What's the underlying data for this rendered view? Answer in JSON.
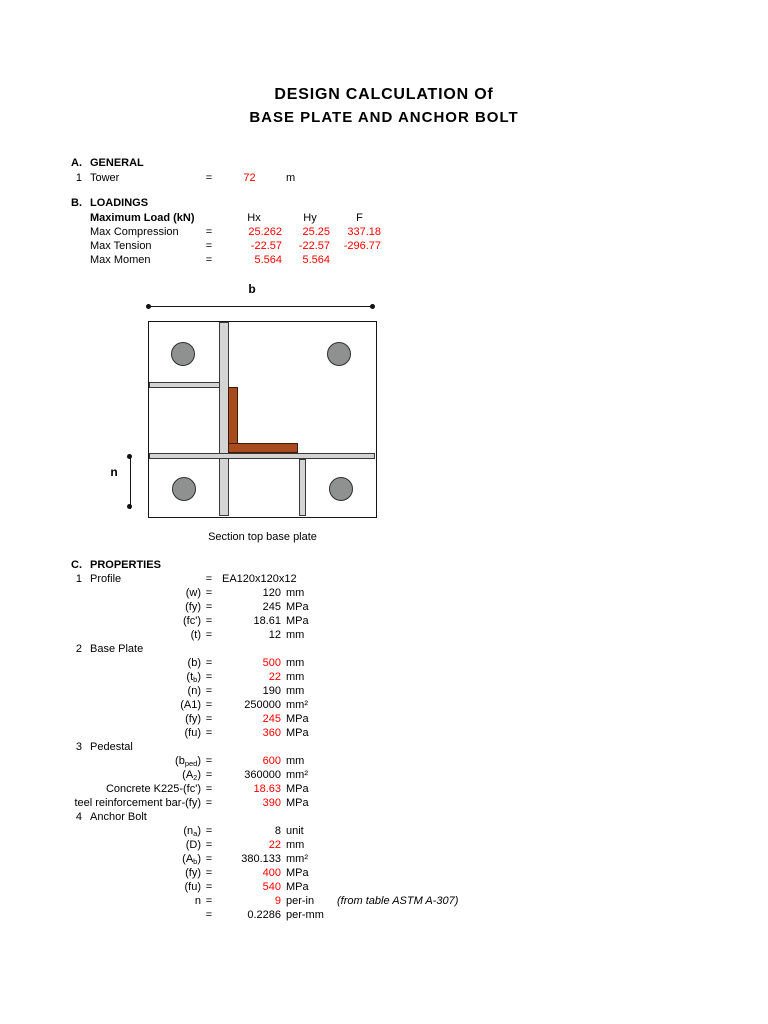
{
  "document": {
    "title_line1": "DESIGN CALCULATION Of",
    "title_line2": "BASE PLATE AND ANCHOR BOLT"
  },
  "colors": {
    "value_red": "#ff0000",
    "text": "#000000",
    "stiffener_fill": "#d4d4d4",
    "bolt_fill": "#8f9191",
    "angle_fill": "#a84b1e"
  },
  "general": {
    "letter": "A.",
    "heading": "GENERAL",
    "rows": [
      {
        "num": "1",
        "label": "Tower",
        "eq": "=",
        "value": "72",
        "red": true,
        "unit": "m"
      }
    ]
  },
  "loadings": {
    "letter": "B.",
    "heading": "LOADINGS",
    "header_label": "Maximum Load (kN)",
    "col_headers": [
      "Hx",
      "Hy",
      "F"
    ],
    "rows": [
      {
        "label": "Max Compression",
        "eq": "=",
        "values": [
          "25.262",
          "25.25",
          "337.18"
        ]
      },
      {
        "label": "Max Tension",
        "eq": "=",
        "values": [
          "-22.57",
          "-22.57",
          "-296.77"
        ]
      },
      {
        "label": "Max Momen",
        "eq": "=",
        "values": [
          "5.564",
          "5.564",
          ""
        ]
      }
    ]
  },
  "diagram": {
    "dim_width_label": "b",
    "dim_height_label": "n",
    "caption": "Section top base plate"
  },
  "properties": {
    "letter": "C.",
    "heading": "PROPERTIES",
    "rows": [
      {
        "type": "item",
        "num": "1",
        "label": "Profile",
        "eq": "=",
        "text_value": "EA120x120x12"
      },
      {
        "type": "param",
        "pre": "(w)",
        "eq": "=",
        "value": "120",
        "red": false,
        "unit": "mm"
      },
      {
        "type": "param",
        "pre": "(fy)",
        "eq": "=",
        "value": "245",
        "red": false,
        "unit": "MPa"
      },
      {
        "type": "param",
        "pre": "(fc')",
        "eq": "=",
        "value": "18.61",
        "red": false,
        "unit": "MPa"
      },
      {
        "type": "param",
        "pre": "(t)",
        "eq": "=",
        "value": "12",
        "red": false,
        "unit": "mm"
      },
      {
        "type": "item",
        "num": "2",
        "label": "Base Plate"
      },
      {
        "type": "param",
        "pre": "(b)",
        "eq": "=",
        "value": "500",
        "red": true,
        "unit": "mm"
      },
      {
        "type": "param",
        "pre": "(t",
        "sub": "b",
        "post": ")",
        "eq": "=",
        "value": "22",
        "red": true,
        "unit": "mm"
      },
      {
        "type": "param",
        "pre": "(n)",
        "eq": "=",
        "value": "190",
        "red": false,
        "unit": "mm"
      },
      {
        "type": "param",
        "pre": "(A1)",
        "eq": "=",
        "value": "250000",
        "red": false,
        "unit": "mm²"
      },
      {
        "type": "param",
        "pre": "(fy)",
        "eq": "=",
        "value": "245",
        "red": true,
        "unit": "MPa"
      },
      {
        "type": "param",
        "pre": "(fu)",
        "eq": "=",
        "value": "360",
        "red": true,
        "unit": "MPa"
      },
      {
        "type": "item",
        "num": "3",
        "label": "Pedestal"
      },
      {
        "type": "param",
        "pre": "(b",
        "sub": "ped",
        "post": ")",
        "eq": "=",
        "value": "600",
        "red": true,
        "unit": "mm"
      },
      {
        "type": "param",
        "pre": "(A",
        "sub": "2",
        "post": ")",
        "eq": "=",
        "value": "360000",
        "red": false,
        "unit": "mm²"
      },
      {
        "type": "param",
        "pre": "Concrete K225-(fc')",
        "eq": "=",
        "value": "18.63",
        "red": true,
        "unit": "MPa"
      },
      {
        "type": "param",
        "pre": "teel reinforcement bar-(fy)",
        "eq": "=",
        "value": "390",
        "red": true,
        "unit": "MPa"
      },
      {
        "type": "item",
        "num": "4",
        "label": "Anchor Bolt"
      },
      {
        "type": "param",
        "pre": "(n",
        "sub": "a",
        "post": ")",
        "eq": "=",
        "value": "8",
        "red": false,
        "unit": "unit"
      },
      {
        "type": "param",
        "pre": "(D)",
        "eq": "=",
        "value": "22",
        "red": true,
        "unit": "mm"
      },
      {
        "type": "param",
        "pre": "(A",
        "sub": "b",
        "post": ")",
        "eq": "=",
        "value": "380.133",
        "red": false,
        "unit": "mm²"
      },
      {
        "type": "param",
        "pre": "(fy)",
        "eq": "=",
        "value": "400",
        "red": true,
        "unit": "MPa"
      },
      {
        "type": "param",
        "pre": "(fu)",
        "eq": "=",
        "value": "540",
        "red": true,
        "unit": "MPa"
      },
      {
        "type": "param",
        "pre": "n",
        "eq": "=",
        "value": "9",
        "red": true,
        "unit": "per-in",
        "note": "(from table ASTM A-307)"
      },
      {
        "type": "param",
        "pre": "",
        "eq": "=",
        "value": "0.2286",
        "red": false,
        "unit": "per-mm"
      }
    ]
  }
}
